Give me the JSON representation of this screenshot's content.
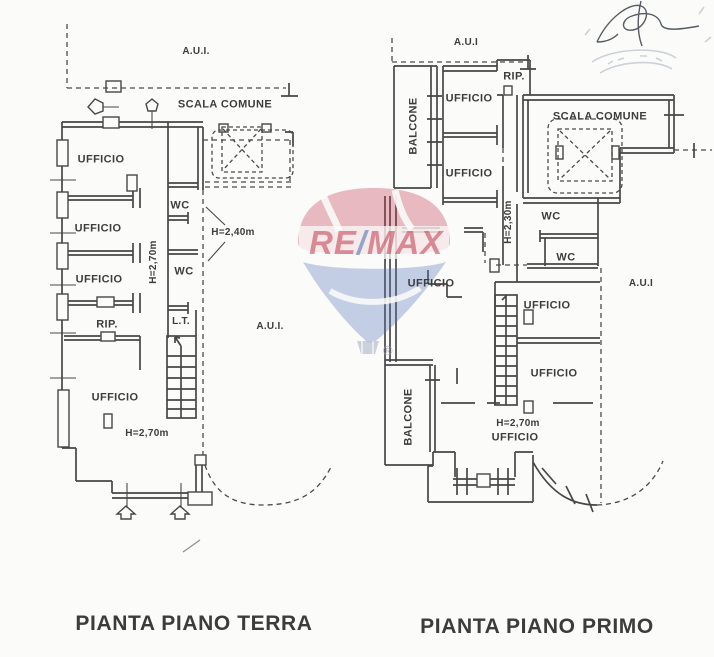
{
  "document_type": "floor plan scan",
  "plans": {
    "terra": {
      "title": "PIANTA PIANO TERRA",
      "labels": {
        "aui_top": "A.U.I.",
        "scala_comune": "SCALA COMUNE",
        "ufficio_1": "UFFICIO",
        "wc_1": "WC",
        "h_wc": "H=2,40m",
        "ufficio_2": "UFFICIO",
        "h_corridoio": "H=2,70m",
        "wc_2": "WC",
        "ufficio_3": "UFFICIO",
        "rip": "RIP.",
        "lt": "L.T.",
        "aui_right": "A.U.I.",
        "ufficio_4": "UFFICIO",
        "h_ufficio": "H=2,70m"
      }
    },
    "primo": {
      "title": "PIANTA PIANO PRIMO",
      "labels": {
        "aui_top": "A.U.I",
        "rip": "RIP.",
        "balcone_top": "BALCONE",
        "ufficio_1": "UFFICIO",
        "scala_comune": "SCALA COMUNE",
        "ufficio_2": "UFFICIO",
        "h_corridoio": "H=2,30m",
        "wc_1": "WC",
        "wc_2": "WC",
        "ufficio_3": "UFFICIO",
        "aui_right": "A.U.I",
        "ufficio_4": "UFFICIO",
        "ufficio_5": "UFFICIO",
        "balcone_bottom": "BALCONE",
        "h_ufficio": "H=2,70m",
        "ufficio_6": "UFFICIO"
      }
    }
  },
  "watermark": {
    "brand_re": "RE",
    "brand_slash": "/",
    "brand_max": "MAX",
    "registered": "®",
    "color_red": "#c43b4e",
    "color_blue": "#5877b8"
  }
}
